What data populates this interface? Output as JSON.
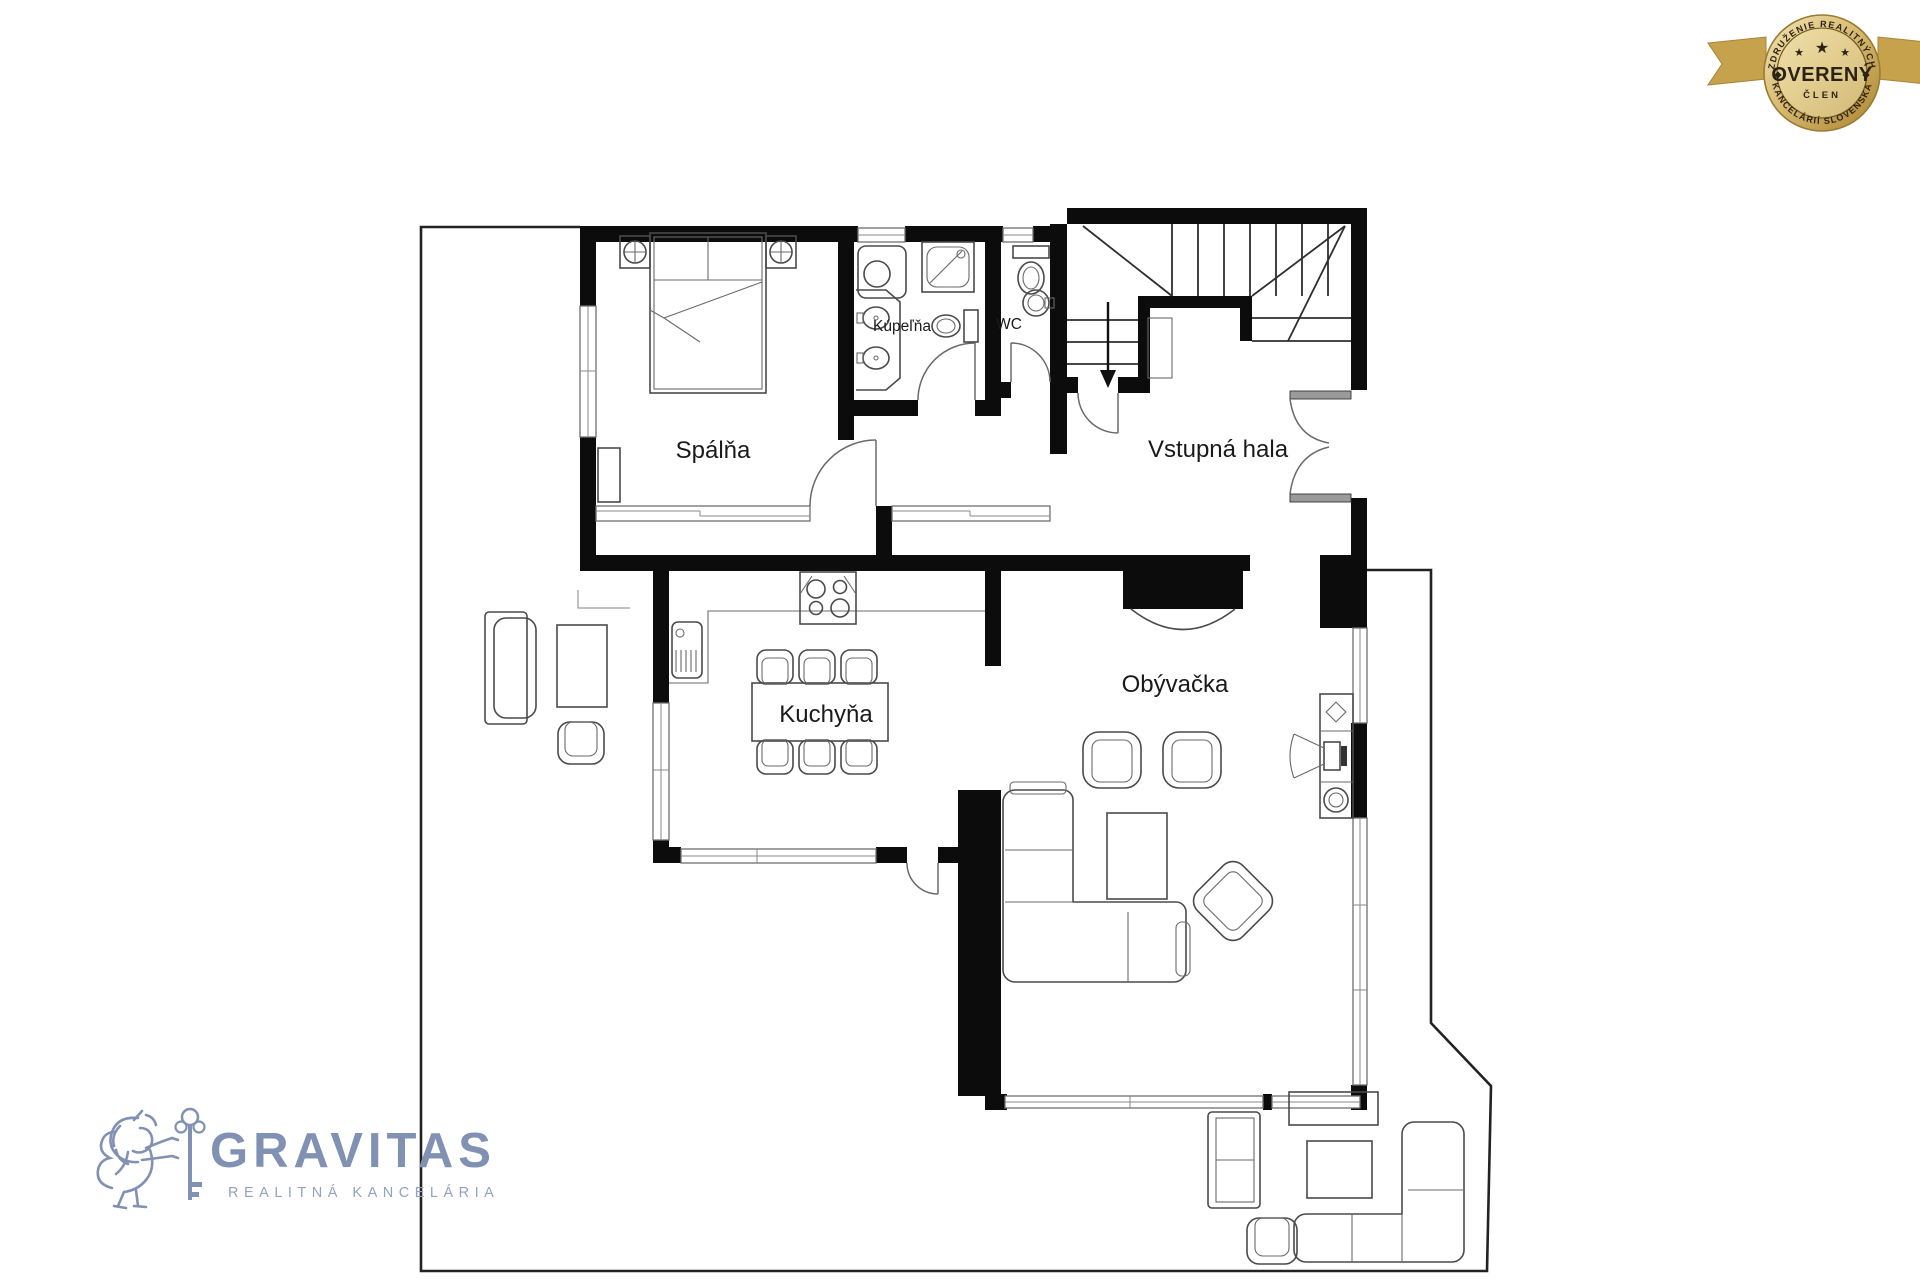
{
  "floor_plan": {
    "rooms": [
      {
        "id": "spalna",
        "label": "Spálňa"
      },
      {
        "id": "kupelna",
        "label": "Kúpeľňa"
      },
      {
        "id": "wc",
        "label": "WC"
      },
      {
        "id": "vstupna-hala",
        "label": "Vstupná hala"
      },
      {
        "id": "kuchyna",
        "label": "Kuchyňa"
      },
      {
        "id": "obyvacka",
        "label": "Obývačka"
      }
    ],
    "colors": {
      "wall": "#0c0c0c",
      "line": "#4a4a4a",
      "background": "#ffffff"
    }
  },
  "logo": {
    "brand": "GRAVITAS",
    "tagline": "REALITNÁ KANCELÁRIA",
    "color": "#8191b3"
  },
  "badge": {
    "arc_top": "ZDRUŽENIE REALITNÝCH",
    "title": "OVERENÝ",
    "subtitle": "ČLEN",
    "arc_bottom": "KANCELÁRIÍ SLOVENSKA",
    "gold_light": "#eedfae",
    "gold_dark": "#b28c3b",
    "text_color": "#2b2115"
  }
}
